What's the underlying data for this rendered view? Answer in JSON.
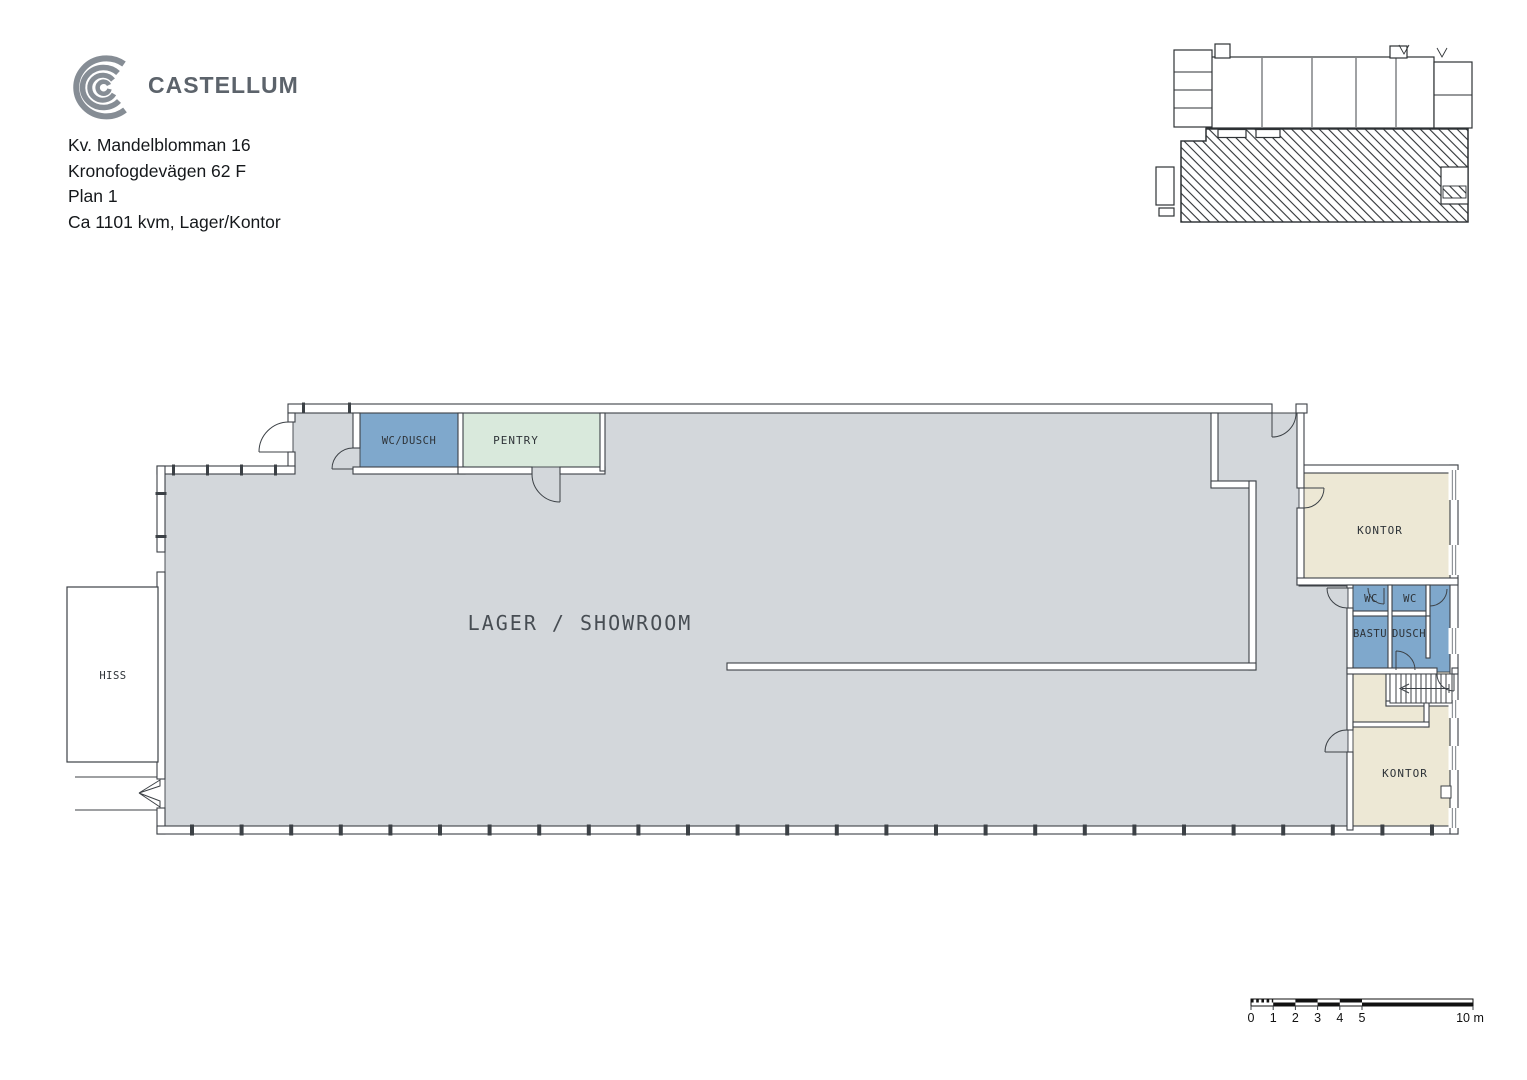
{
  "header": {
    "brand": "CASTELLUM",
    "address_line_1": "Kv. Mandelblomman 16",
    "address_line_2": "Kronofogdevägen 62 F",
    "address_line_3": "Plan 1",
    "address_line_4": "Ca 1101 kvm, Lager/Kontor"
  },
  "plan": {
    "rooms": {
      "lager_showroom": "LAGER / SHOWROOM",
      "wc_dusch": "WC/DUSCH",
      "pentry": "PENTRY",
      "hiss": "HISS",
      "kontor_upper": "KONTOR",
      "wc_1": "WC",
      "wc_2": "WC",
      "bastu": "BASTU",
      "dusch": "DUSCH",
      "kontor_lower": "KONTOR"
    },
    "colors": {
      "floor_gray": "#D3D7DB",
      "wet_blue": "#7FA8CC",
      "pentry_green": "#D9E9DC",
      "office_beige": "#EDE8D5",
      "wall_line": "#3C4146"
    }
  },
  "scale_bar": {
    "labels": [
      "0",
      "1",
      "2",
      "3",
      "4",
      "5"
    ],
    "end_label": "10 m"
  }
}
